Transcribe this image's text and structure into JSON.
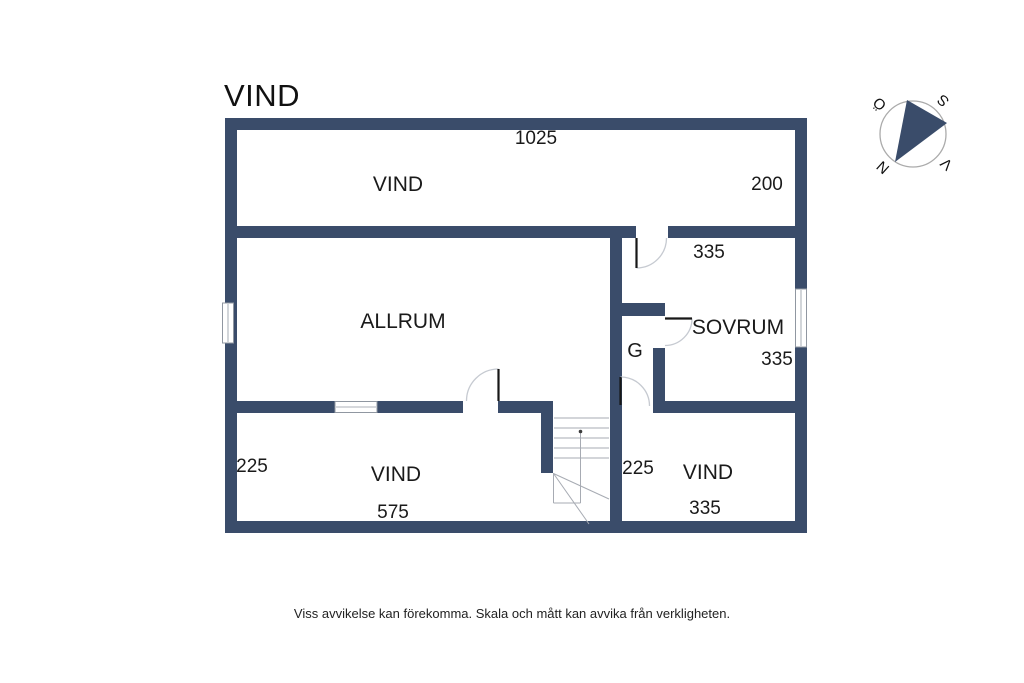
{
  "page": {
    "title": "VIND",
    "footer_disclaimer": "Viss avvikelse kan förekomma. Skala och mått kan avvika från verkligheten."
  },
  "floor_plan": {
    "rooms": {
      "vind_top": {
        "label": "VIND"
      },
      "allrum": {
        "label": "ALLRUM"
      },
      "sovrum": {
        "label": "SOVRUM"
      },
      "garderob": {
        "label": "G"
      },
      "vind_bottom_left": {
        "label": "VIND"
      },
      "vind_bottom_right": {
        "label": "VIND"
      }
    },
    "dimensions": {
      "overall_width": "1025",
      "vind_top_depth": "200",
      "hall_width": "335",
      "sovrum_depth": "335",
      "vind_bottom_left_depth": "225",
      "vind_bottom_left_width": "575",
      "stair_hall_depth": "225",
      "vind_bottom_right_width": "335"
    },
    "compass": {
      "north": "N",
      "south": "S",
      "east": "Ö",
      "west": "V"
    },
    "colors": {
      "wall": "#3A4C6A",
      "text": "#1a1a1a",
      "door_arc": "#c6cad1",
      "stair_lines": "#A7ABB3"
    }
  }
}
